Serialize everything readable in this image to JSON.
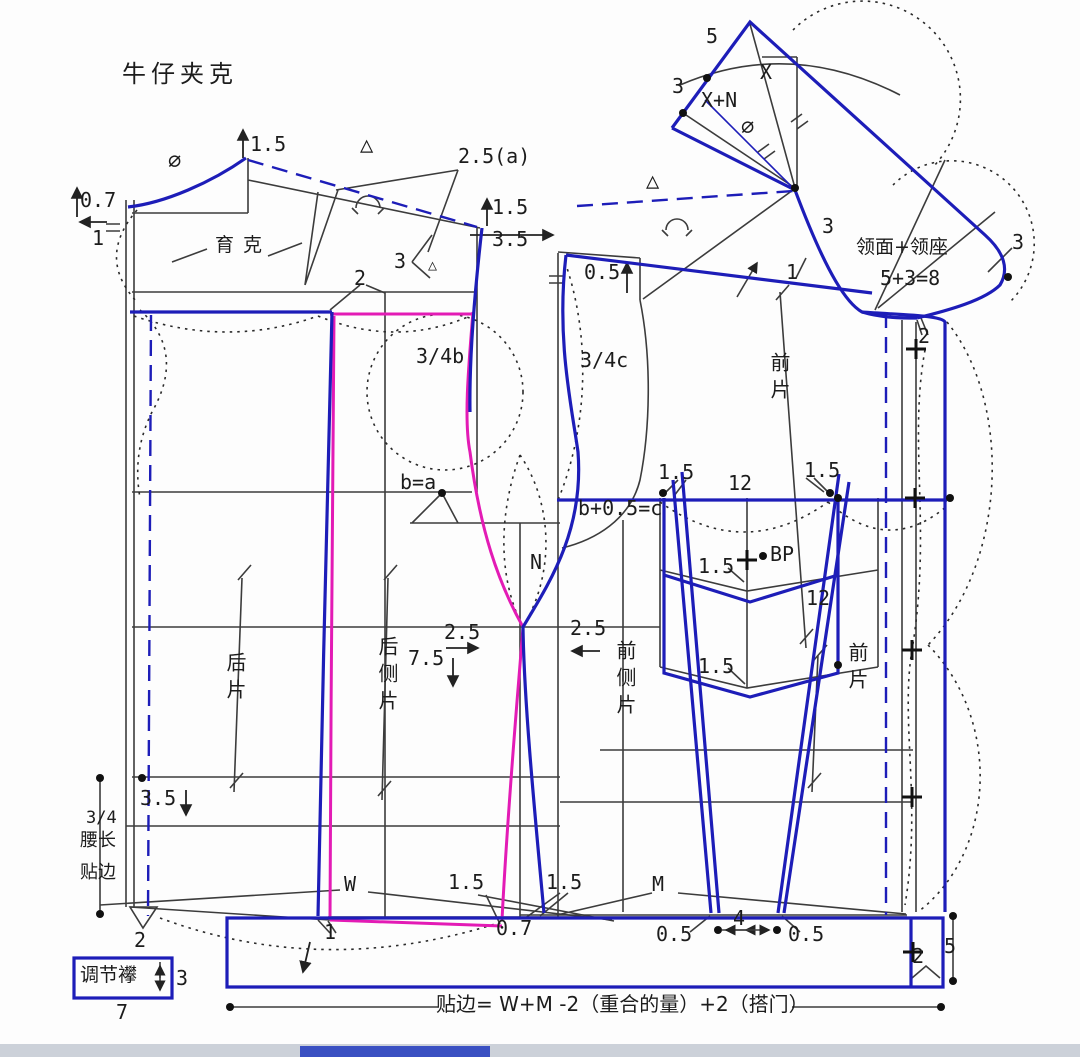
{
  "title": "牛仔夹克",
  "colors": {
    "pattern_blue": "#1d1db8",
    "style_magenta": "#e31bb5",
    "draft_line": "#3c3c3c"
  },
  "labels": {
    "yoke": "育克",
    "back_piece": "后片",
    "back_side_piece": "后侧片",
    "front_side_piece": "前侧片",
    "front_piece_upper": "前片",
    "front_piece_lower": "前片",
    "collar_name": "领面+领座",
    "collar_sum": "5+3=8",
    "waist_fraction": "3/4",
    "waist_length": "腰长",
    "facing": "贴边",
    "adjust_tab": "调节襻",
    "formula": "贴边= W+M -2（重合的量）+2（搭门）",
    "bp": "BP",
    "x": "X",
    "x_plus_n": "X+N",
    "b_equals_a": "b=a",
    "b_plus": "b+0.5=c",
    "n": "N",
    "b34": "3/4b",
    "c34": "3/4c",
    "w": "W",
    "m": "M",
    "phi": "∅",
    "tri": "△"
  },
  "nums": {
    "n07": "0.7",
    "n1": "1",
    "n15": "1.5",
    "n2": "2",
    "n25": "2.5",
    "n25a": "2.5(a)",
    "n3": "3",
    "n35": "3.5",
    "n05": "0.5",
    "n5": "5",
    "n4": "4",
    "n7": "7",
    "n12": "12",
    "n75": "7.5"
  }
}
